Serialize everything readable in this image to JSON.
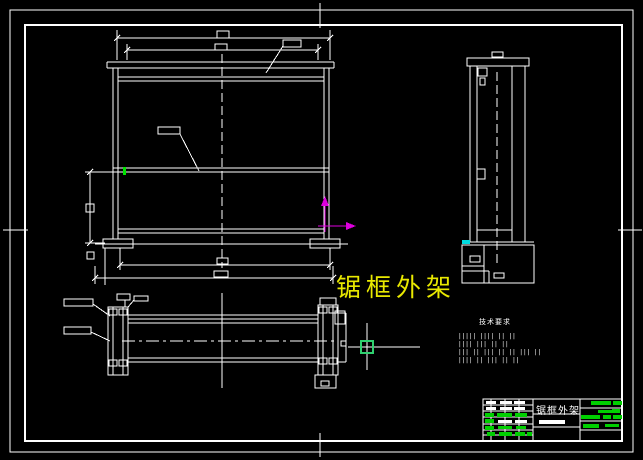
{
  "canvas": {
    "background": "#000000",
    "line_color": "#ffffff"
  },
  "annotation_label": {
    "text": "锯框外架",
    "color": "#e8e800"
  },
  "tech_notes": {
    "title": "技术要求",
    "title_color": "#ffffff",
    "lines": [
      {
        "y": 334,
        "text": "||||| |||| || ||"
      },
      {
        "y": 342,
        "text": "|||| ||| || ||"
      },
      {
        "y": 350,
        "text": "||| || ||| || || ||| ||"
      },
      {
        "y": 358,
        "text": "|||| || ||| || ||"
      }
    ]
  },
  "title_block": {
    "title": "锯框外架",
    "title_color": "#ffffff",
    "green": "#00d000",
    "white": "#ffffff",
    "bars": [
      {
        "x": 486,
        "y": 401,
        "w": 10,
        "h": 3,
        "c": "w"
      },
      {
        "x": 500,
        "y": 401,
        "w": 12,
        "h": 3,
        "c": "w"
      },
      {
        "x": 514,
        "y": 401,
        "w": 11,
        "h": 3,
        "c": "w"
      },
      {
        "x": 486,
        "y": 407,
        "w": 10,
        "h": 3,
        "c": "w"
      },
      {
        "x": 500,
        "y": 407,
        "w": 12,
        "h": 3,
        "c": "w"
      },
      {
        "x": 514,
        "y": 407,
        "w": 11,
        "h": 3,
        "c": "w"
      },
      {
        "x": 485,
        "y": 413,
        "w": 9,
        "h": 4,
        "c": "g"
      },
      {
        "x": 497,
        "y": 413,
        "w": 15,
        "h": 4,
        "c": "g"
      },
      {
        "x": 515,
        "y": 413,
        "w": 12,
        "h": 4,
        "c": "g"
      },
      {
        "x": 485,
        "y": 419,
        "w": 9,
        "h": 4,
        "c": "g"
      },
      {
        "x": 498,
        "y": 420,
        "w": 14,
        "h": 3,
        "c": "w"
      },
      {
        "x": 515,
        "y": 420,
        "w": 12,
        "h": 3,
        "c": "w"
      },
      {
        "x": 485,
        "y": 426,
        "w": 9,
        "h": 4,
        "c": "g"
      },
      {
        "x": 498,
        "y": 426,
        "w": 14,
        "h": 3,
        "c": "g"
      },
      {
        "x": 516,
        "y": 426,
        "w": 10,
        "h": 3,
        "c": "g"
      },
      {
        "x": 487,
        "y": 432,
        "w": 8,
        "h": 4,
        "c": "g"
      },
      {
        "x": 499,
        "y": 432,
        "w": 13,
        "h": 4,
        "c": "g"
      },
      {
        "x": 515,
        "y": 432,
        "w": 10,
        "h": 4,
        "c": "g"
      },
      {
        "x": 527,
        "y": 432,
        "w": 5,
        "h": 4,
        "c": "g"
      },
      {
        "x": 591,
        "y": 401,
        "w": 20,
        "h": 4,
        "c": "g"
      },
      {
        "x": 613,
        "y": 401,
        "w": 9,
        "h": 4,
        "c": "g"
      },
      {
        "x": 598,
        "y": 410,
        "w": 14,
        "h": 3,
        "c": "g"
      },
      {
        "x": 612,
        "y": 409,
        "w": 8,
        "h": 4,
        "c": "g"
      },
      {
        "x": 581,
        "y": 415,
        "w": 19,
        "h": 4,
        "c": "g"
      },
      {
        "x": 603,
        "y": 415,
        "w": 8,
        "h": 4,
        "c": "g"
      },
      {
        "x": 613,
        "y": 415,
        "w": 9,
        "h": 4,
        "c": "g"
      },
      {
        "x": 583,
        "y": 424,
        "w": 16,
        "h": 4,
        "c": "g"
      },
      {
        "x": 605,
        "y": 424,
        "w": 14,
        "h": 3,
        "c": "g"
      },
      {
        "x": 539,
        "y": 420,
        "w": 26,
        "h": 4,
        "c": "w"
      }
    ]
  },
  "icons": {
    "ucs_axis_icon_color": "#dd00dd",
    "pickbox_color": "#2fd06f",
    "osnap_tick_green": "#00e400",
    "osnap_tick_cyan": "#00dce0"
  }
}
